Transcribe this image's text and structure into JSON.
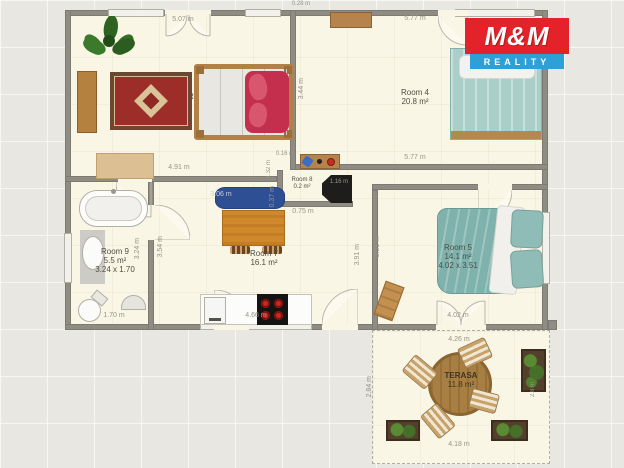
{
  "logo": {
    "title": "M&M",
    "subtitle": "REALITY"
  },
  "colors": {
    "logo_red": "#e32329",
    "logo_blue": "#2da0d8",
    "wall_gray": "#8f8c83",
    "floor_cream": "#faf6e6",
    "sofa_blue": "#2f4f95",
    "bed_teal": "#8fbcb6",
    "duvet_red": "#c42f4e"
  },
  "rooms": {
    "room2": {
      "name": "Room 2",
      "area": "m²"
    },
    "room4": {
      "name": "Room 4",
      "area": "20.8 m²"
    },
    "room5": {
      "name": "Room 5",
      "area": "14.1 m²",
      "size": "4.02 x 3.51"
    },
    "room7": {
      "name": "Room 7",
      "area": "16.1 m²"
    },
    "room8": {
      "name": "Room 8",
      "area": "0.2 m²"
    },
    "room9": {
      "name": "Room 9",
      "area": "5.5 m²",
      "size": "3.24 x 1.70"
    },
    "terrace": {
      "name": "TERASA",
      "area": "11.8 m²"
    }
  },
  "dimensions": {
    "room2_door": "5.07 m",
    "room2_bottom": "4.91 m",
    "room4_top": "5.77 m",
    "room4_bottom": "5.77 m",
    "room4_left": "3.44 m",
    "wall_top": "0.28 m",
    "hall_gap": "0.16 m",
    "hall_left": "1.32 m",
    "hall_bottom": "0.75 m",
    "sofa_width": "3.06 m",
    "sofa_depth": "0.37 m",
    "fireplace": "1.16 m",
    "room9_right": "3.24 m",
    "room9_bottom": "1.70 m",
    "room7_left": "3.54 m",
    "room7_right": "3.91 m",
    "room7_bottom": "4.66 m",
    "room5_left": "3.51 m",
    "room5_bottom": "4.02 m",
    "terrace_top": "4.26 m",
    "terrace_bottom": "4.18 m",
    "terrace_left": "2.84 m",
    "terrace_right": "2.8 m"
  }
}
